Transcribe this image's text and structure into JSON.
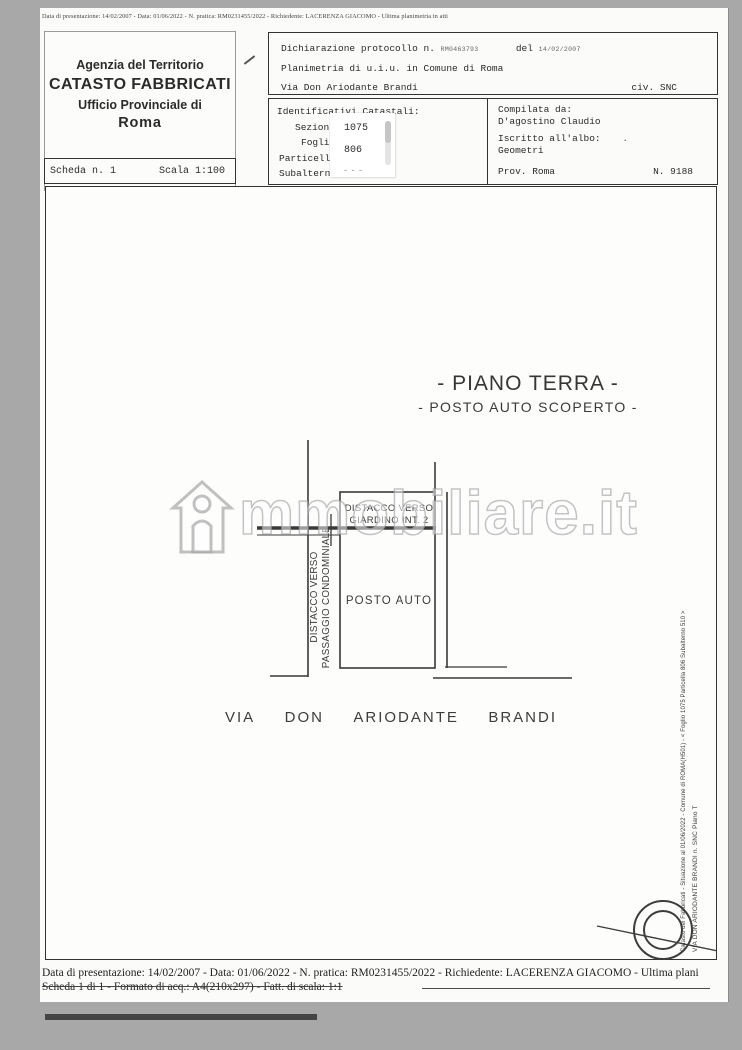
{
  "page": {
    "top_strip_text": "Data di presentazione: 14/02/2007 - Data: 01/06/2022 - N. pratica: RM0231455/2022 - Richiedente: LACERENZA GIACOMO - Ultima planimetria in atti"
  },
  "header": {
    "agency": {
      "line1": "Agenzia del Territorio",
      "line2": "CATASTO FABBRICATI",
      "line3": "Ufficio Provinciale di",
      "line4": "Roma"
    },
    "scheda": {
      "label": "Scheda n. 1",
      "scale": "Scala 1:100"
    },
    "declaration": {
      "protocol_label": "Dichiarazione protocollo n.",
      "protocol_value": "RM0463793",
      "del_label": "del",
      "date_value": "14/02/2007",
      "line2": "Planimetria di u.i.u. in Comune di Roma",
      "line3": "Via Don Ariodante Brandi",
      "civ": "civ. SNC"
    },
    "identifiers": {
      "title": "Identificativi Catastali:",
      "sezione_label": "Sezion",
      "foglio_label": "Fogli",
      "particella_label": "Particell",
      "subalterno_label": "Subaltern",
      "foglio_value": "1075",
      "particella_value": "806",
      "subalterno_value": "- - -"
    },
    "compiler": {
      "title": "Compilata da:",
      "name": "D'agostino Claudio",
      "albo_label": "Iscritto all'albo:",
      "albo_mark": ".",
      "albo_value": "Geometri",
      "prov": "Prov. Roma",
      "number": "N. 9188"
    }
  },
  "drawing": {
    "title1": "- PIANO TERRA -",
    "title2": "- POSTO AUTO SCOPERTO -",
    "label_giardino_1": "DISTACCO VERSO",
    "label_giardino_2": "GIARDINO INT. 2",
    "label_passaggio_1": "DISTACCO VERSO",
    "label_passaggio_2": "PASSAGGIO CONDOMINIALE",
    "label_posto_auto": "POSTO AUTO",
    "street_words": [
      "VIA",
      "DON",
      "ARIODANTE",
      "BRANDI"
    ],
    "side_text_outer": "Catasto dei Fabbricati - Situazione al 01/06/2022 - Comune di ROMA(H501) - < Foglio 1075 Particella 806 Subalterno 510 >",
    "side_text_inner": "VIA DON ARIODANTE BRANDI n. SNC Piano T"
  },
  "watermark": {
    "text": "mmobiliare.it"
  },
  "footer": {
    "line1": "Data di presentazione: 14/02/2007 - Data: 01/06/2022 - N. pratica: RM0231455/2022 - Richiedente: LACERENZA GIACOMO - Ultima plani",
    "line2": "Scheda 1 di 1 - Formato di acq.: A4(210x297) - Fatt. di scala: 1:1"
  },
  "colors": {
    "outer_bg": "#a8a8a8",
    "page_bg": "#fbfbf9",
    "ink": "#2b2b2b"
  }
}
